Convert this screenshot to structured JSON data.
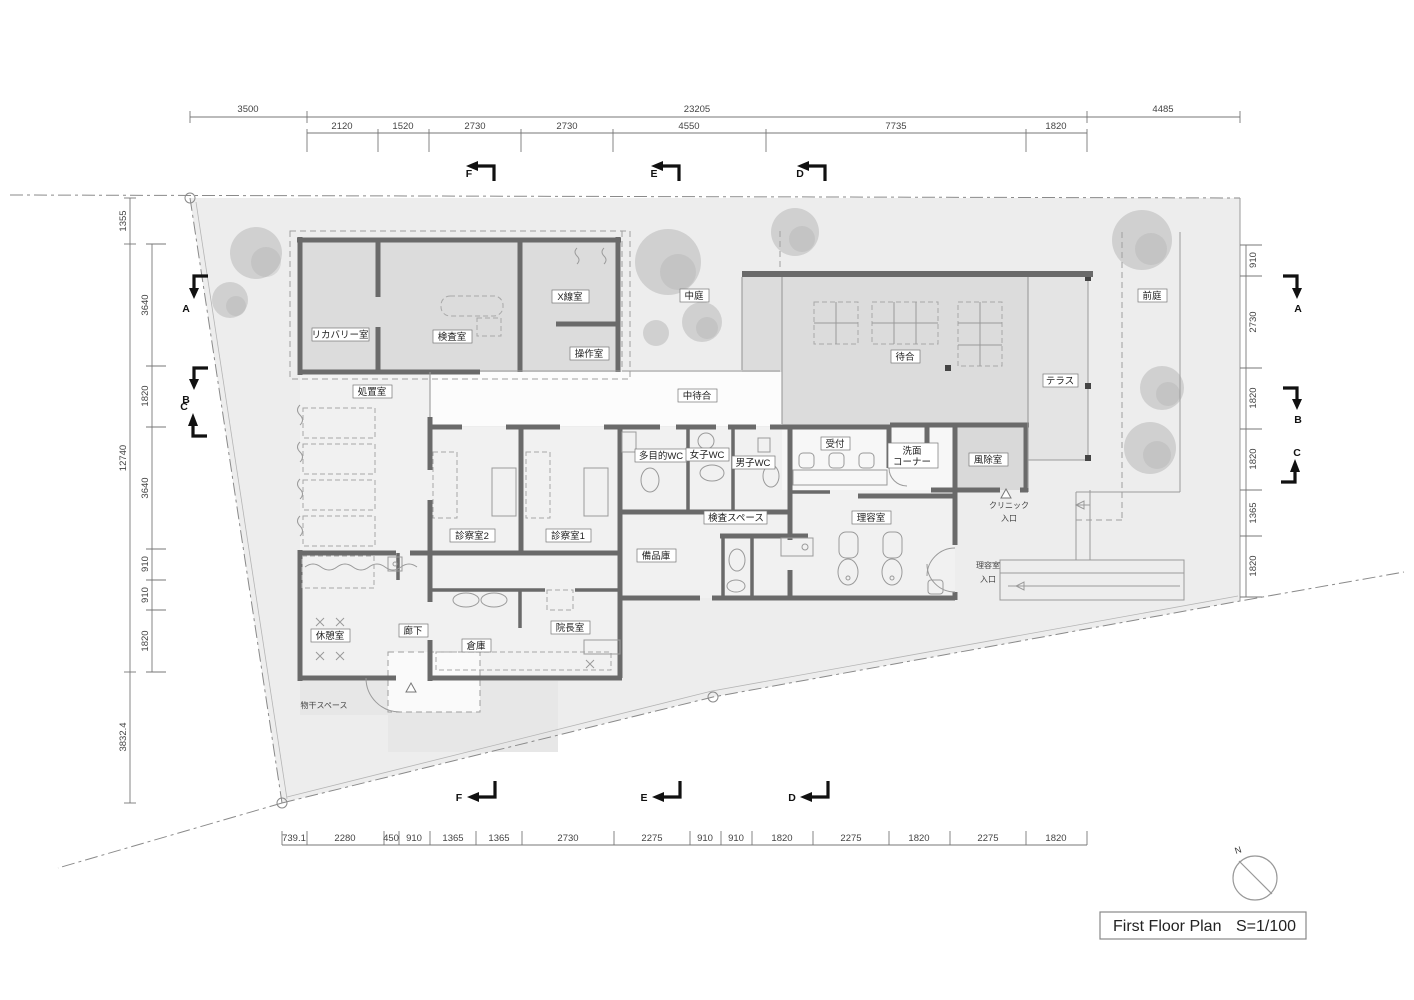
{
  "title_block": {
    "main": "First Floor Plan",
    "scale": "S=1/100"
  },
  "north_label": "N",
  "rooms": {
    "recovery": "リカバリー室",
    "exam": "検査室",
    "xray": "X線室",
    "control": "操作室",
    "treatment": "処置室",
    "courtyard": "中庭",
    "inner_waiting": "中待合",
    "waiting": "待合",
    "terrace": "テラス",
    "front_garden": "前庭",
    "wc_multi": "多目的WC",
    "wc_women": "女子WC",
    "wc_men": "男子WC",
    "reception": "受付",
    "wash1": "洗面",
    "wash2": "コーナー",
    "vestibule": "風除室",
    "exam_space": "検査スペース",
    "barber": "理容室",
    "consult2": "診察室2",
    "consult1": "診察室1",
    "supply": "備品庫",
    "break_room": "休憩室",
    "corridor": "廊下",
    "storage": "倉庫",
    "director": "院長室",
    "laundry": "物干スペース"
  },
  "entrances": {
    "clinic1": "クリニック",
    "clinic2": "入口",
    "barber1": "理容室",
    "barber2": "入口"
  },
  "sections": [
    "A",
    "B",
    "C",
    "D",
    "E",
    "F"
  ],
  "dims": {
    "top_outer": [
      "3500",
      "23205",
      "4485"
    ],
    "top_inner": [
      "2120",
      "1520",
      "2730",
      "2730",
      "4550",
      "7735",
      "1820"
    ],
    "left_outer": [
      "1355",
      "12740",
      "3832.4"
    ],
    "left_inner": [
      "3640",
      "1820",
      "3640",
      "910",
      "910",
      "1820"
    ],
    "right_col": [
      "910",
      "2730",
      "1820",
      "1820",
      "1365",
      "1820"
    ],
    "bottom": [
      "739.1",
      "2280",
      "450",
      "910",
      "1365",
      "1365",
      "2730",
      "2275",
      "910",
      "910",
      "1820",
      "2275",
      "1820",
      "2275",
      "1820"
    ]
  },
  "colors": {
    "wall": "#6a6a6a",
    "site": "#ededed",
    "room-shade": "#dcdcdc",
    "floor": "#f1f1f1",
    "line": "#9a9a9a",
    "boundary": "#8a8a8a",
    "tree": "#a9a9a9",
    "text": "#222222"
  }
}
